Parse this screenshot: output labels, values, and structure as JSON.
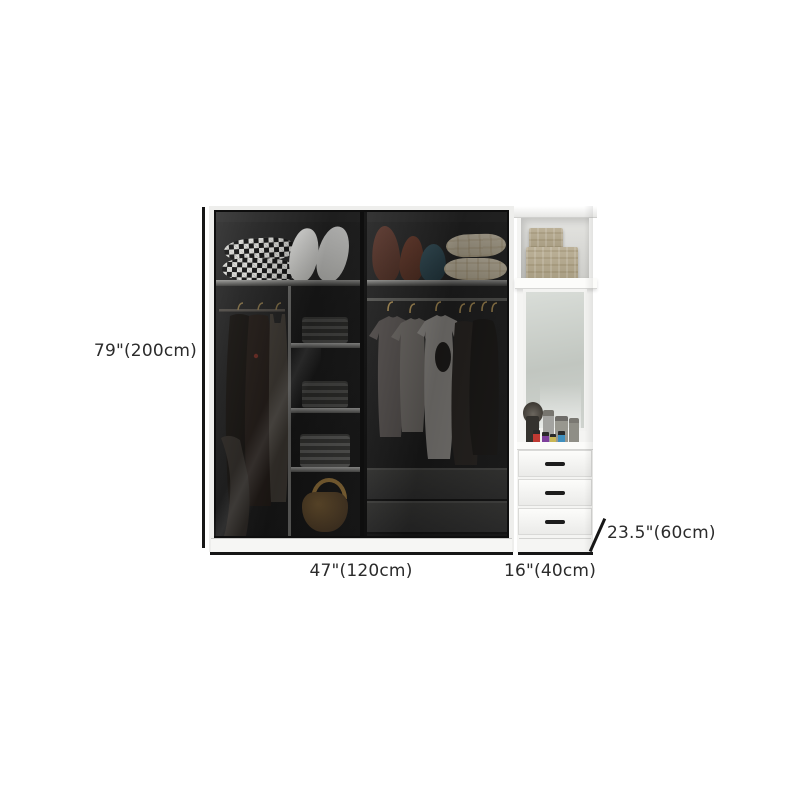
{
  "annotations": {
    "height_label": "79\"(200cm)",
    "width_label": "47\"(120cm)",
    "side_width_label": "16\"(40cm)",
    "depth_label": "23.5\"(60cm)"
  },
  "colors": {
    "background": "#ffffff",
    "dimension_line": "#161616",
    "label_text": "#2b2b2b",
    "wardrobe_frame": "#eeeeec",
    "wardrobe_interior": "#1d1d1d",
    "glass_tint": "rgba(0,0,0,0.30)",
    "cabinet_body": "#f4f4f2",
    "mirror": "#c9cec9",
    "storage_box": "#b0a58b",
    "handbag": "#54402a",
    "hanger": "#a98d55",
    "drawer_handle": "#1c1c1c",
    "nail_polish_red": "#bf3a33",
    "nail_polish_purple": "#7d3f9c",
    "nail_polish_yellow": "#c9b654",
    "nail_polish_blue": "#3f8fbe"
  }
}
